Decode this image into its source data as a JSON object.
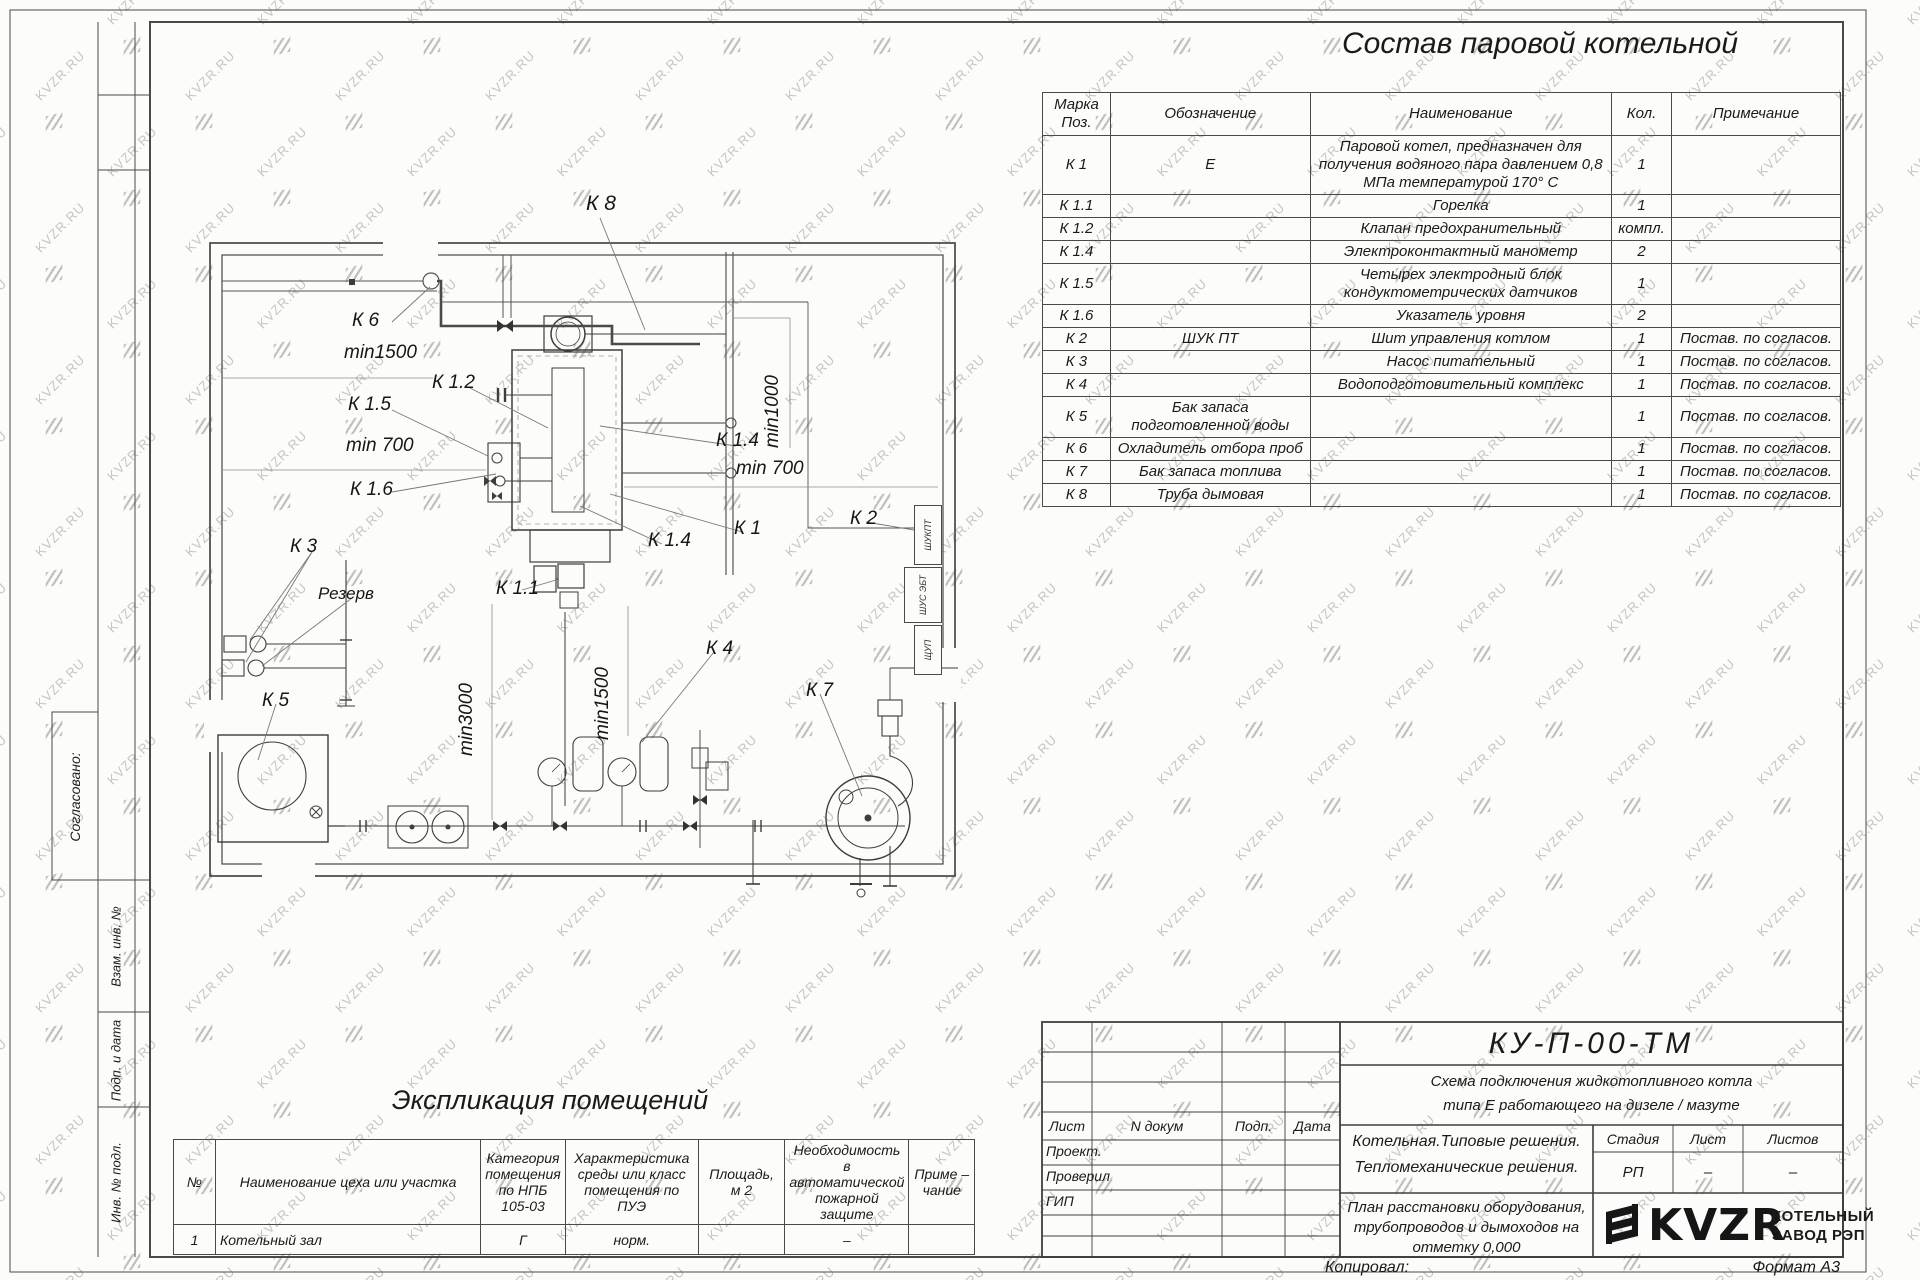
{
  "watermark": {
    "text": "KVZR.RU"
  },
  "drawing_title": "Состав паровой котельной",
  "equipment_table": {
    "headers": [
      "Марка\nПоз.",
      "Обозначение",
      "Наименование",
      "Кол.",
      "Примечание"
    ],
    "rows": [
      {
        "mark": "К 1",
        "designation": "Е",
        "name": "Паровой котел, предназначен для получения водяного пара давлением  0,8  МПа температурой  170° С",
        "qty": "1",
        "note": ""
      },
      {
        "mark": "К 1.1",
        "designation": "",
        "name": "Горелка",
        "qty": "1",
        "note": ""
      },
      {
        "mark": "К 1.2",
        "designation": "",
        "name": "Клапан предохранительный",
        "qty": "компл.",
        "note": ""
      },
      {
        "mark": "К 1.4",
        "designation": "",
        "name": "Электроконтактный манометр",
        "qty": "2",
        "note": ""
      },
      {
        "mark": "К 1.5",
        "designation": "",
        "name": "Четырех электродный блок кондуктометрических датчиков",
        "qty": "1",
        "note": ""
      },
      {
        "mark": "К 1.6",
        "designation": "",
        "name": "Указатель уровня",
        "qty": "2",
        "note": ""
      },
      {
        "mark": "К 2",
        "designation": "ШУК ПТ",
        "name": "Шит управления котлом",
        "qty": "1",
        "note": "Постав. по согласов."
      },
      {
        "mark": "К 3",
        "designation": "",
        "name": "Насос питательный",
        "qty": "1",
        "note": "Постав. по согласов."
      },
      {
        "mark": "К 4",
        "designation": "",
        "name": "Водоподготовительный комплекс",
        "qty": "1",
        "note": "Постав. по согласов."
      },
      {
        "mark": "К 5",
        "designation": "Бак запаса подготовленной воды",
        "name": "",
        "qty": "1",
        "note": "Постав. по согласов."
      },
      {
        "mark": "К 6",
        "designation": "Охладитель отбора проб",
        "name": "",
        "qty": "1",
        "note": "Постав. по согласов."
      },
      {
        "mark": "К 7",
        "designation": "Бак запаса топлива",
        "name": "",
        "qty": "1",
        "note": "Постав. по согласов."
      },
      {
        "mark": "К 8",
        "designation": "Труба дымовая",
        "name": "",
        "qty": "1",
        "note": "Постав. по согласов."
      }
    ]
  },
  "plan": {
    "labels": [
      {
        "t": "К 8",
        "x": 586,
        "y": 192,
        "s": 21
      },
      {
        "t": "К 6",
        "x": 352,
        "y": 310,
        "s": 19
      },
      {
        "t": "min1500",
        "x": 344,
        "y": 342,
        "s": 19
      },
      {
        "t": "К 1.2",
        "x": 432,
        "y": 372,
        "s": 19
      },
      {
        "t": "К 1.5",
        "x": 348,
        "y": 394,
        "s": 19
      },
      {
        "t": "min 700",
        "x": 346,
        "y": 435,
        "s": 19
      },
      {
        "t": "К 1.6",
        "x": 350,
        "y": 479,
        "s": 19
      },
      {
        "t": "min1000",
        "x": 762,
        "y": 448,
        "s": 19,
        "r": -90
      },
      {
        "t": "К 1.4",
        "x": 716,
        "y": 430,
        "s": 19
      },
      {
        "t": "min 700",
        "x": 736,
        "y": 458,
        "s": 19
      },
      {
        "t": "К 1",
        "x": 734,
        "y": 518,
        "s": 19
      },
      {
        "t": "К 1.4",
        "x": 648,
        "y": 530,
        "s": 19
      },
      {
        "t": "К 2",
        "x": 850,
        "y": 508,
        "s": 19
      },
      {
        "t": "К 3",
        "x": 290,
        "y": 536,
        "s": 19
      },
      {
        "t": "Резерв",
        "x": 318,
        "y": 584,
        "s": 17
      },
      {
        "t": "К 1.1",
        "x": 496,
        "y": 578,
        "s": 19
      },
      {
        "t": "min3000",
        "x": 456,
        "y": 756,
        "s": 19,
        "r": -90
      },
      {
        "t": "min1500",
        "x": 592,
        "y": 740,
        "s": 19,
        "r": -90
      },
      {
        "t": "К 4",
        "x": 706,
        "y": 638,
        "s": 19
      },
      {
        "t": "К 5",
        "x": 262,
        "y": 690,
        "s": 19
      },
      {
        "t": "К 7",
        "x": 806,
        "y": 680,
        "s": 19
      }
    ],
    "panels": [
      "ШУКПТ",
      "ШУС ЭБТ",
      "ЩУП"
    ]
  },
  "explication": {
    "title": "Экспликация помещений",
    "headers": [
      "№",
      "Наименование цеха или участка",
      "Категория\nпомещения\nпо НПБ\n105-03",
      "Характеристика\nсреды или класс\nпомещения по\nПУЭ",
      "Площадь,\nм 2",
      "Необходимость в\nавтоматической\nпожарной защите",
      "Приме –\nчание"
    ],
    "rows": [
      [
        "1",
        "Котельный зал",
        "Г",
        "норм.",
        "",
        "–",
        ""
      ]
    ]
  },
  "left_margin": {
    "labels": [
      "Согласовано:",
      "Взам. инв. №",
      "Подп. и дата",
      "Инв. № подл."
    ]
  },
  "title_block": {
    "doc_number": "КУ-П-00-ТМ",
    "scheme_title_line1": "Схема подключения жидкотопливного котла",
    "scheme_title_line2": "типа Е работающего на дизеле / мазуте",
    "header_cells": [
      "Лист",
      "N докум",
      "Подп.",
      "Дата"
    ],
    "role_rows": [
      "Проект.",
      "Проверил",
      "ГИП"
    ],
    "project_line1": "Котельная.Типовые решения.",
    "project_line2": "Тепломеханические решения.",
    "stage_header": [
      "Стадия",
      "Лист",
      "Листов"
    ],
    "stage_values": [
      "РП",
      "–",
      "–"
    ],
    "sheet_title_line1": "План расстановки оборудования,",
    "sheet_title_line2": "трубопроводов и дымоходов на",
    "sheet_title_line3": "отметку  0,000",
    "logo_text": "KVZR",
    "company_name_line1": "КОТЕЛЬНЫЙ",
    "company_name_line2": "ЗАВОД РЭП",
    "copied_label": "Копировал:",
    "format_label": "Формат А3"
  }
}
